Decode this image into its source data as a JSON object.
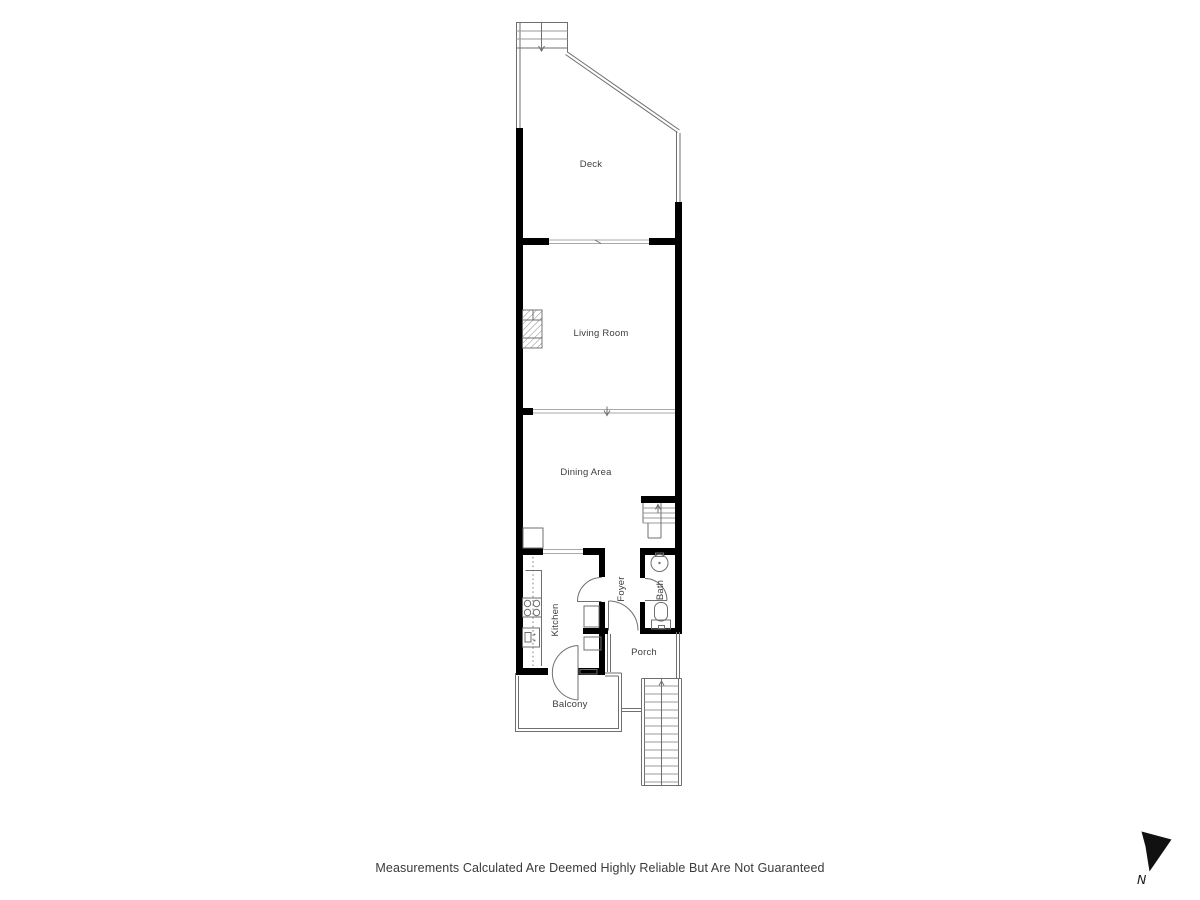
{
  "css_vars": {
    "--bg": "#ffffff",
    "--wall": "#000000",
    "--thin": "#6f6f6f",
    "--tread": "#9a9a9a",
    "--label": "#3d3d3d",
    "--footer": "#3a3a3a"
  },
  "rooms": {
    "deck": {
      "label": "Deck"
    },
    "living_room": {
      "label": "Living Room"
    },
    "dining_area": {
      "label": "Dining Area"
    },
    "kitchen": {
      "label": "Kitchen"
    },
    "foyer": {
      "label": "Foyer"
    },
    "bath": {
      "label": "Bath"
    },
    "porch": {
      "label": "Porch"
    },
    "balcony": {
      "label": "Balcony"
    }
  },
  "footer": {
    "disclaimer": "Measurements Calculated Are Deemed Highly Reliable But Are Not Guaranteed"
  },
  "compass": {
    "label": "N"
  }
}
